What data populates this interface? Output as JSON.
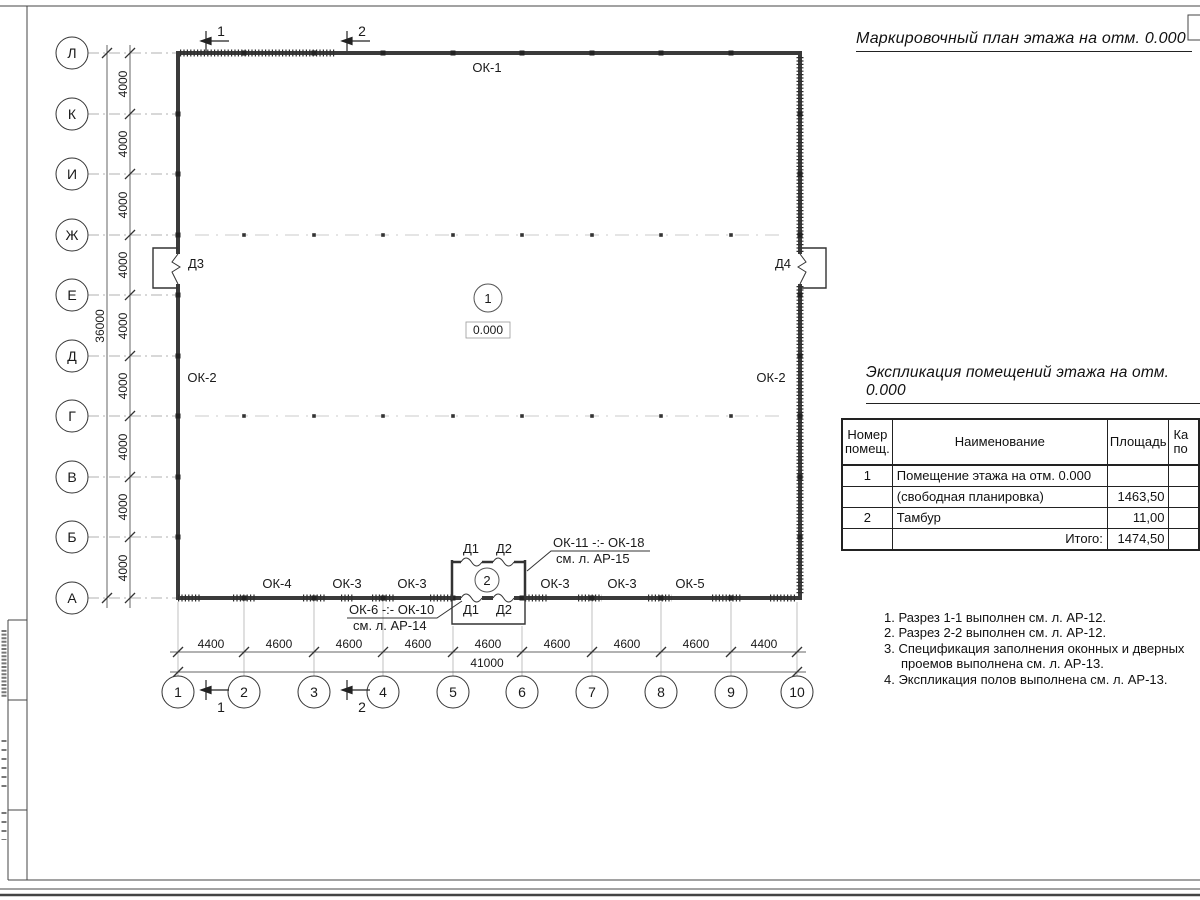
{
  "titles": {
    "plan": "Маркировочный план этажа на отм. 0.000",
    "schedule": "Экспликация помещений этажа на отм. 0.000"
  },
  "axes": {
    "rows": [
      "Л",
      "К",
      "И",
      "Ж",
      "Е",
      "Д",
      "Г",
      "В",
      "Б",
      "А"
    ],
    "cols": [
      "1",
      "2",
      "3",
      "4",
      "5",
      "6",
      "7",
      "8",
      "9",
      "10"
    ],
    "row_dims": [
      "4000",
      "4000",
      "4000",
      "4000",
      "4000",
      "4000",
      "4000",
      "4000",
      "4000"
    ],
    "row_total": "36000",
    "col_dims": [
      "4400",
      "4600",
      "4600",
      "4600",
      "4600",
      "4600",
      "4600",
      "4600",
      "4400"
    ],
    "col_total": "41000"
  },
  "plan": {
    "section1": "1",
    "section2": "2",
    "room1": "1",
    "room2": "2",
    "level": "0.000",
    "ok1": "ОК-1",
    "ok2": "ОК-2",
    "bottom_windows": [
      "ОК-4",
      "ОК-3",
      "ОК-3",
      "ОК-3",
      "ОК-3",
      "ОК-5"
    ],
    "d1": "Д1",
    "d2": "Д2",
    "d3": "Д3",
    "d4": "Д4",
    "callout_top": {
      "l1": "ОК-11 -:- ОК-18",
      "l2": "см. л. АР-15"
    },
    "callout_bottom": {
      "l1": "ОК-6 -:- ОК-10",
      "l2": "см. л. АР-14"
    }
  },
  "schedule": {
    "h_num1": "Номер",
    "h_num2": "помещ.",
    "h_name": "Наименование",
    "h_area": "Площадь",
    "h_cut1": "Ка",
    "h_cut2": "по",
    "rows": [
      {
        "num": "1",
        "name": "Помещение этажа на отм. 0.000",
        "area": ""
      },
      {
        "num": "",
        "name": "(свободная планировка)",
        "area": "1463,50"
      },
      {
        "num": "2",
        "name": "Тамбур",
        "area": "11,00"
      },
      {
        "num": "",
        "name": "Итого:",
        "area": "1474,50"
      }
    ]
  },
  "notes": [
    "1. Разрез 1-1 выполнен см. л. АР-12.",
    "2. Разрез 2-2 выполнен см. л. АР-12.",
    "3. Спецификация заполнения оконных и дверных проемов выполнена см. л. АР-13.",
    "4. Экспликация полов выполнена см. л. АР-13."
  ]
}
